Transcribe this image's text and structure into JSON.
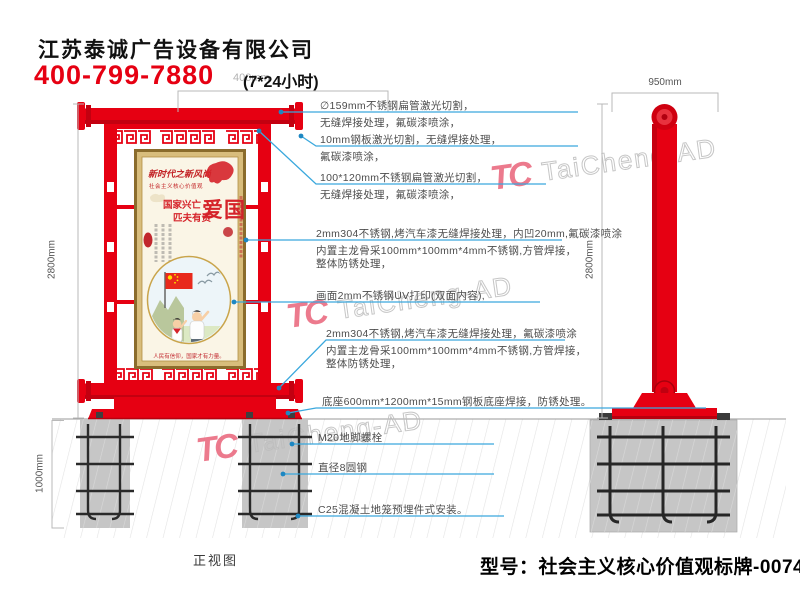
{
  "header": {
    "company": "江苏泰诚广告设备有限公司",
    "phone": "400-799-7880",
    "hours": "(7*24小时)",
    "hidden_dim": "400mm"
  },
  "dimensions": {
    "front_height": "2800mm",
    "side_height": "2800mm",
    "foundation_depth": "1000mm",
    "side_width": "950mm"
  },
  "annotations": [
    {
      "lines": [
        "∅159mm不锈钢扁管激光切割，",
        "无缝焊接处理，氟碳漆喷涂，"
      ]
    },
    {
      "lines": [
        "10mm钢板激光切割，无缝焊接处理，",
        "氟碳漆喷涂，"
      ]
    },
    {
      "lines": [
        "100*120mm不锈钢扁管激光切割，",
        "无缝焊接处理，氟碳漆喷涂，"
      ]
    },
    {
      "lines": [
        "2mm304不锈钢,烤汽车漆无缝焊接处理，内凹20mm,氟碳漆喷涂",
        "内置主龙骨采100mm*100mm*4mm不锈钢,方管焊接，",
        "整体防锈处理，"
      ]
    },
    {
      "lines": [
        "画面2mm不锈钢UV打印(双面内容),"
      ]
    },
    {
      "lines": [
        "2mm304不锈钢,烤汽车漆无缝焊接处理，氟碳漆喷涂",
        "内置主龙骨采100mm*100mm*4mm不锈钢,方管焊接，",
        "整体防锈处理，"
      ]
    },
    {
      "lines": [
        "底座600mm*1200mm*15mm钢板底座焊接，防锈处理。"
      ]
    },
    {
      "lines": [
        "M20地脚螺栓"
      ]
    },
    {
      "lines": [
        "直径8圆钢"
      ]
    },
    {
      "lines": [
        "C25混凝土地笼预埋件式安装。"
      ]
    }
  ],
  "poster": {
    "calligraphy": "新时代之新风尚",
    "banner": "社会主义核心价值观",
    "headline": "爱国",
    "couplet_line1": "国家兴亡",
    "couplet_line2": "匹夫有责",
    "footer_slogan": "人民有信仰，国家才有力量。"
  },
  "watermark": {
    "logo_text": "TC",
    "brand_text": "TaiCheng-AD"
  },
  "labels": {
    "front_view": "正视图",
    "model": "型号：社会主义核心价值观标牌-0074"
  },
  "colors": {
    "primary_red": "#e60012",
    "leader_blue": "#3aa8dd",
    "concrete_gray": "#c6c6c6",
    "dim_gray": "#b9b9b9"
  }
}
